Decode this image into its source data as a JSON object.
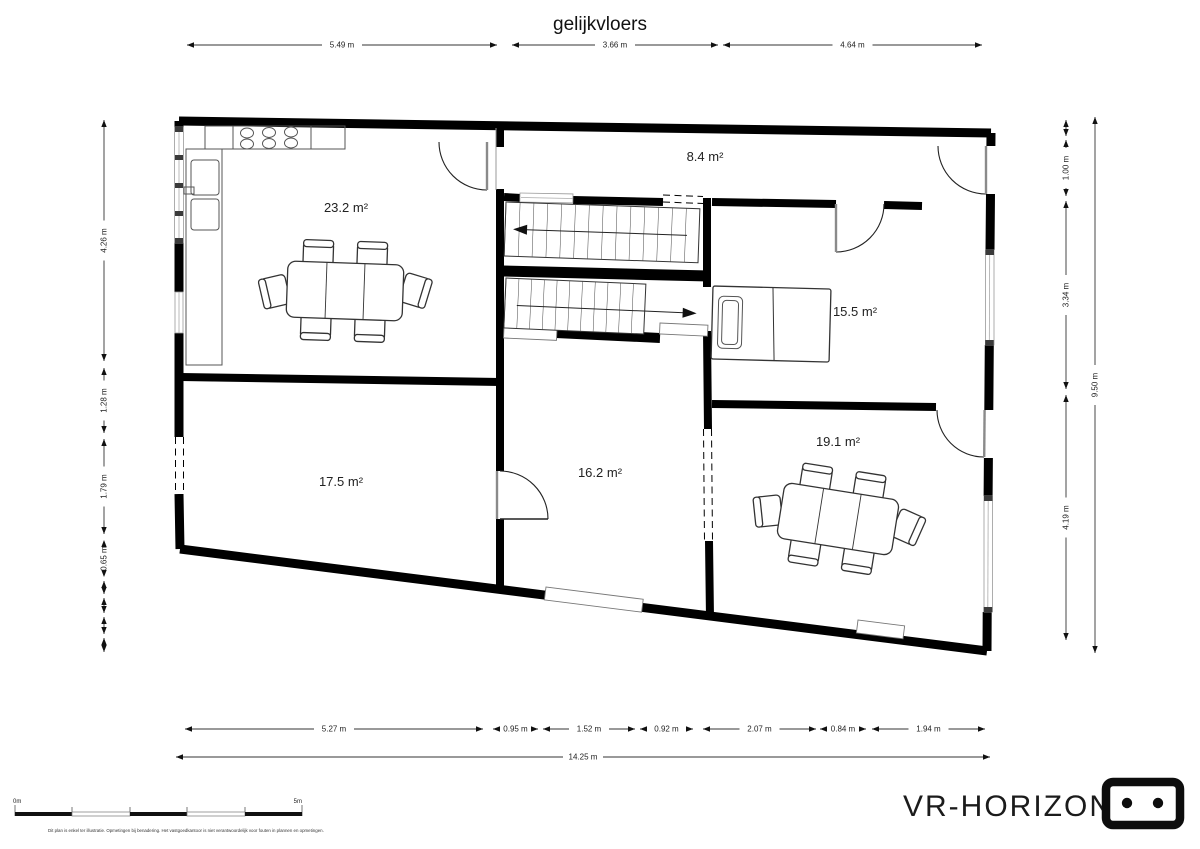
{
  "title": "gelijkvloers",
  "rooms": [
    {
      "id": "living-kitchen",
      "area_label": "23.2 m²"
    },
    {
      "id": "hall",
      "area_label": "8.4 m²"
    },
    {
      "id": "bedroom",
      "area_label": "15.5 m²"
    },
    {
      "id": "front-room-left",
      "area_label": "17.5 m²"
    },
    {
      "id": "middle-room",
      "area_label": "16.2 m²"
    },
    {
      "id": "dining-room",
      "area_label": "19.1 m²"
    }
  ],
  "dimensions": {
    "top": [
      "5.49 m",
      "3.66 m",
      "4.64 m"
    ],
    "left": [
      "4.26 m",
      "1.28 m",
      "1.79 m",
      "0.65 m"
    ],
    "right": [
      "1.00 m",
      "3.34 m",
      "4.19 m"
    ],
    "right_total": "9.50 m",
    "bottom": [
      "5.27 m",
      "0.95 m",
      "1.52 m",
      "0.92 m",
      "2.07 m",
      "0.84 m",
      "1.94 m"
    ],
    "bottom_total": "14.25 m"
  },
  "scale_bar": {
    "start_label": "0m",
    "end_label": "5m"
  },
  "disclaimer": "Dit plan is enkel ter illustratie. Opmetingen bij benadering. Het vastgoedkantoor is niet verantwoordelijk voor fouten in plannen en opmetingen.",
  "branding": {
    "logo_text": "VR-HORIZON"
  }
}
